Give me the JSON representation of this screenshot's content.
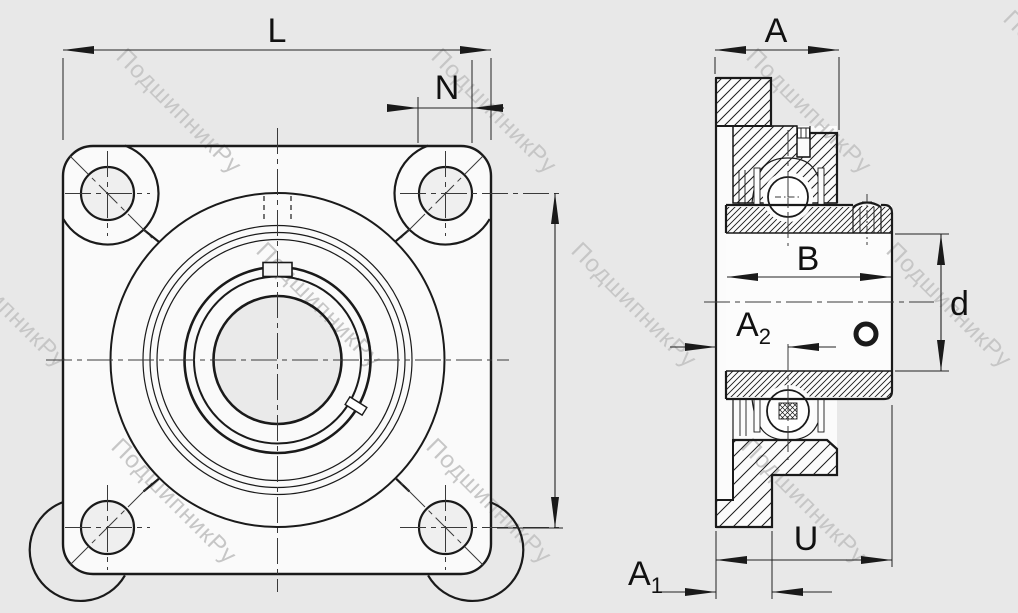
{
  "watermark": {
    "text": "ПодшипникРу",
    "color": "#c6c6c6",
    "positions": [
      [
        115,
        58
      ],
      [
        430,
        58
      ],
      [
        745,
        58
      ],
      [
        1002,
        20
      ],
      [
        -60,
        252
      ],
      [
        255,
        252
      ],
      [
        570,
        252
      ],
      [
        885,
        252
      ],
      [
        110,
        448
      ],
      [
        425,
        448
      ],
      [
        740,
        448
      ]
    ]
  },
  "drawing": {
    "background": "#e8e8e8",
    "part_fill": "#fafafa",
    "line_color": "#1a1a1a",
    "views": [
      "front-view-4-bolt-flange",
      "side-section-view"
    ]
  },
  "dimensions": {
    "L": {
      "label": "L"
    },
    "N": {
      "label": "N"
    },
    "A": {
      "label": "A"
    },
    "B": {
      "label": "B"
    },
    "d": {
      "label": "d"
    },
    "A2": {
      "base": "A",
      "sub": "2"
    },
    "U": {
      "label": "U"
    },
    "A1": {
      "base": "A",
      "sub": "1"
    }
  }
}
